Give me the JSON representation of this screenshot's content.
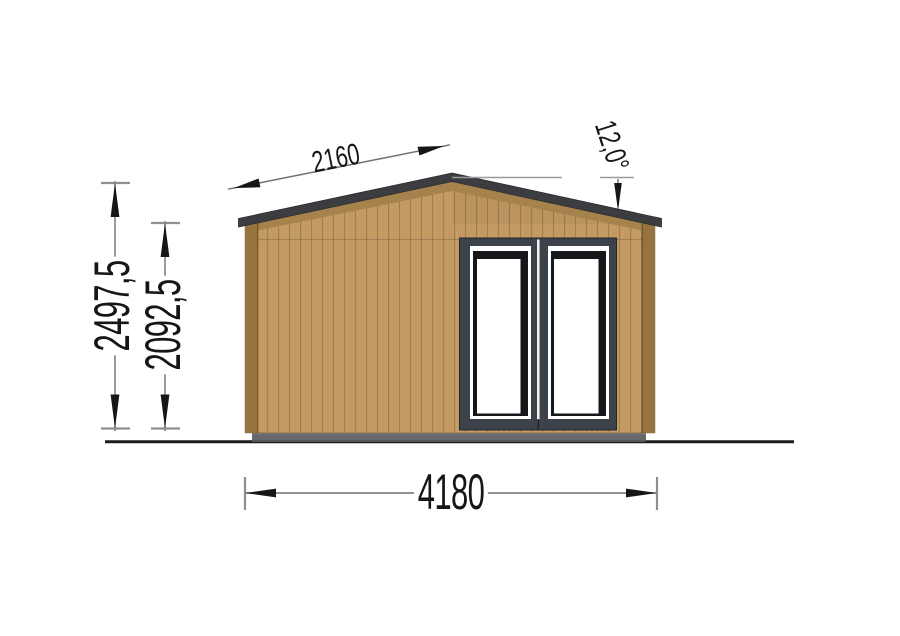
{
  "drawing": {
    "type": "technical-elevation",
    "subject": "garden-cabin-front-elevation",
    "dimensions": {
      "roof_slope_length": {
        "label": "2160",
        "unit": "mm"
      },
      "roof_angle": {
        "label": "12,0°"
      },
      "overall_height": {
        "label": "2497,5",
        "unit": "mm"
      },
      "wall_height": {
        "label": "2092,5",
        "unit": "mm"
      },
      "overall_width": {
        "label": "4180",
        "unit": "mm"
      }
    },
    "colors": {
      "wall": "#c29a62",
      "plank": "#8d6c3c",
      "soffit": "#a6824d",
      "trim": "#97743f",
      "fascia": "#3c3d40",
      "door_frame": "#3b4249",
      "sash": "#15171a",
      "glass": "#ffffff",
      "divider": "#f0f0f0",
      "base": "#66686b",
      "base_edge": "#55575a",
      "ground": "#1c1c1c",
      "dim_line": "#6f6f6f",
      "dim_tick": "#8f8f8f",
      "dim_arrow": "#161616",
      "dim_text": "#161616"
    }
  }
}
